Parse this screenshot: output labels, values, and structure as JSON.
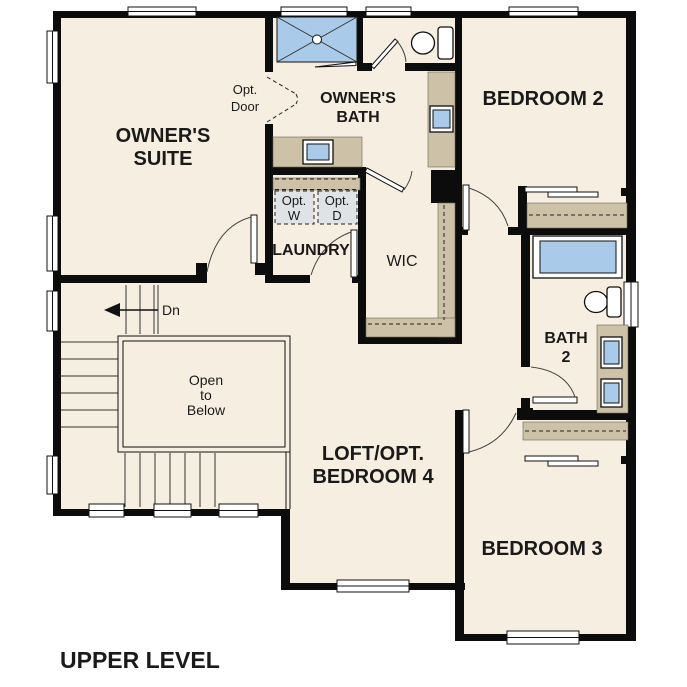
{
  "title": "UPPER LEVEL",
  "rooms": {
    "owners_suite": {
      "label": "OWNER'S SUITE",
      "lines": [
        "OWNER'S",
        "SUITE"
      ]
    },
    "owners_bath": {
      "label": "OWNER'S BATH",
      "lines": [
        "OWNER'S",
        "BATH"
      ]
    },
    "bedroom2": {
      "label": "BEDROOM 2"
    },
    "laundry": {
      "label": "LAUNDRY"
    },
    "wic": {
      "label": "WIC"
    },
    "bath2": {
      "label": "BATH 2",
      "lines": [
        "BATH",
        "2"
      ]
    },
    "loft": {
      "label": "LOFT/OPT. BEDROOM 4",
      "lines": [
        "LOFT/OPT.",
        "BEDROOM 4"
      ]
    },
    "bedroom3": {
      "label": "BEDROOM 3"
    }
  },
  "annotations": {
    "opt_door": {
      "lines": [
        "Opt.",
        "Door"
      ]
    },
    "opt_washer": {
      "lines": [
        "Opt.",
        "W"
      ]
    },
    "opt_dryer": {
      "lines": [
        "Opt.",
        "D"
      ]
    },
    "stairs_down": "Dn",
    "open_to_below": {
      "lines": [
        "Open",
        "to",
        "Below"
      ]
    }
  },
  "fixtures": [
    "shower",
    "toilet",
    "bathtub",
    "double-sink-vanity",
    "sink",
    "washer",
    "dryer",
    "stairs",
    "railing",
    "closet-shelves"
  ],
  "colors": {
    "floor": "#f6eee1",
    "walls": "#0c0c0c",
    "counters": "#cdc1a8",
    "fixture_blue": "#a9cbe9",
    "appliance_gray": "#e0e3e5",
    "outside": "#ffffff",
    "text": "#1a1a1a"
  }
}
